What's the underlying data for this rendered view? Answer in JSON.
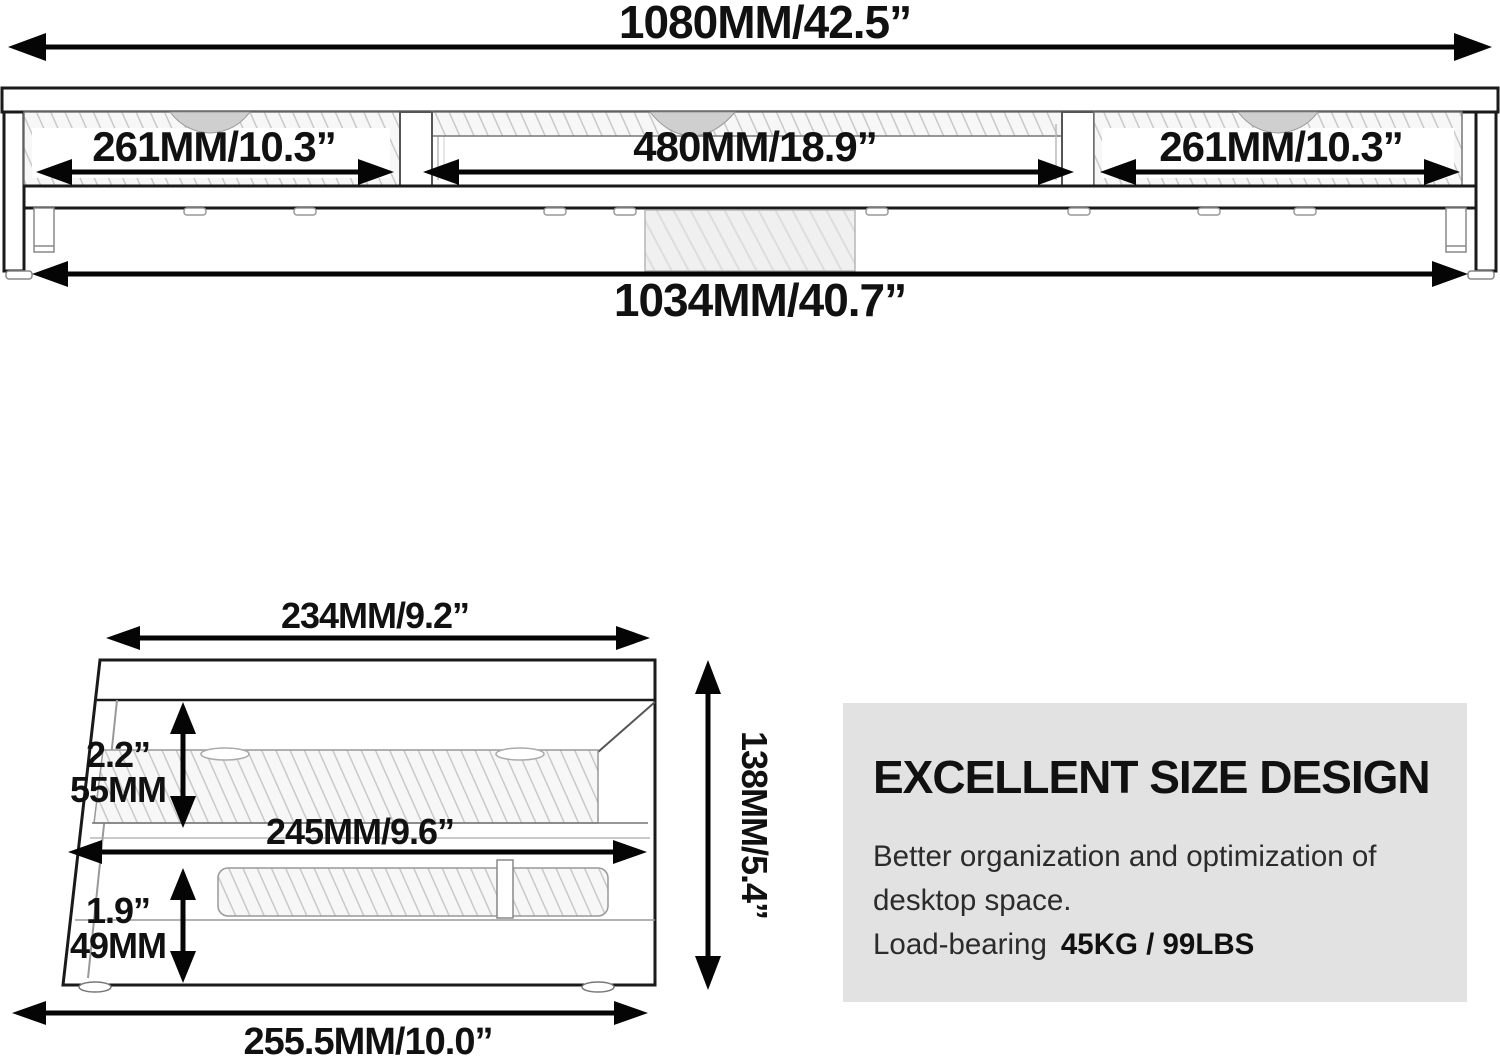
{
  "front_view": {
    "overall_width": "1080MM/42.5”",
    "left_section": "261MM/10.3”",
    "middle_section": "480MM/18.9”",
    "right_section": "261MM/10.3”",
    "base_width": "1034MM/40.7”"
  },
  "side_view": {
    "top_depth": "234MM/9.2”",
    "upper_clearance_in": "2.2”",
    "upper_clearance_mm": "55MM",
    "middle_depth": "245MM/9.6”",
    "lower_clearance_in": "1.9”",
    "lower_clearance_mm": "49MM",
    "height": "138MM/5.4”",
    "base_depth": "255.5MM/10.0”"
  },
  "info_box": {
    "title": "EXCELLENT SIZE DESIGN",
    "line1": "Better organization and optimization of",
    "line2": "desktop space.",
    "load_label": "Load-bearing",
    "load_value": "45KG / 99LBS",
    "background_color": "#e2e2e2",
    "text_color": "#111111"
  }
}
